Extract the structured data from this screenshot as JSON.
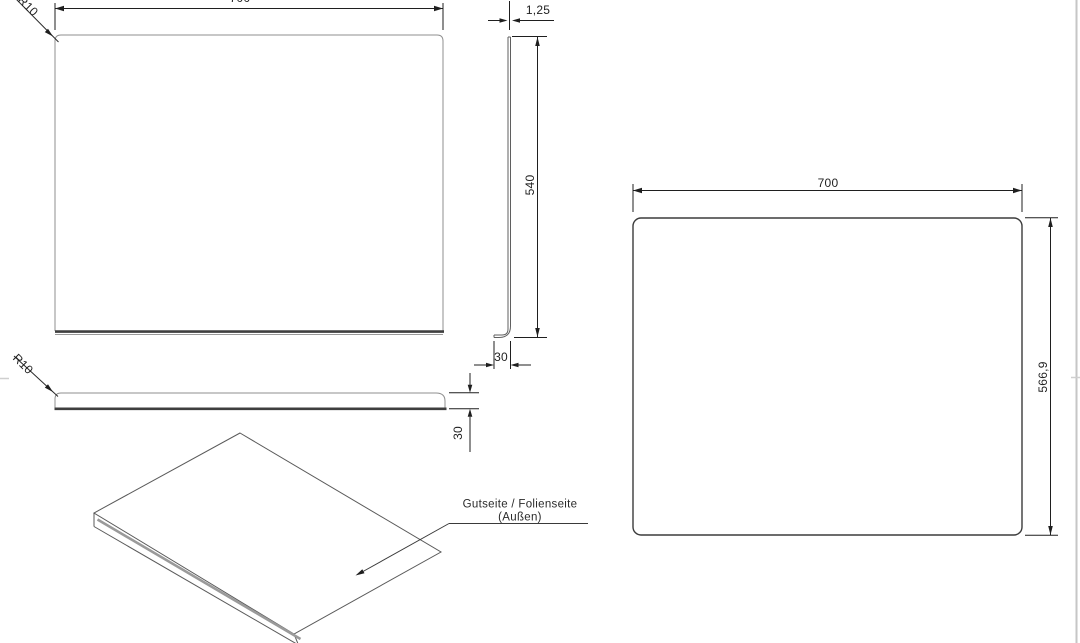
{
  "sheet": {
    "background": "#ffffff",
    "border_color": "#c6c6c6"
  },
  "line_colors": {
    "part_outline": "#8f8f8f",
    "thick_edge": "#3f3f3f",
    "iso_edge": "#5a5a5a",
    "annotation": "#1f1f1f"
  },
  "front_view": {
    "width": "700",
    "corner_radius": "R10"
  },
  "side_view": {
    "thickness": "1,25",
    "height": "540",
    "flange_depth": "30"
  },
  "bottom_view": {
    "corner_radius": "R10",
    "flange_depth": "30"
  },
  "flat_pattern_view": {
    "width": "700",
    "height": "566,9"
  },
  "isometric_view": {
    "note_line1": "Gutseite / Folienseite",
    "note_line2": "(Außen)"
  }
}
